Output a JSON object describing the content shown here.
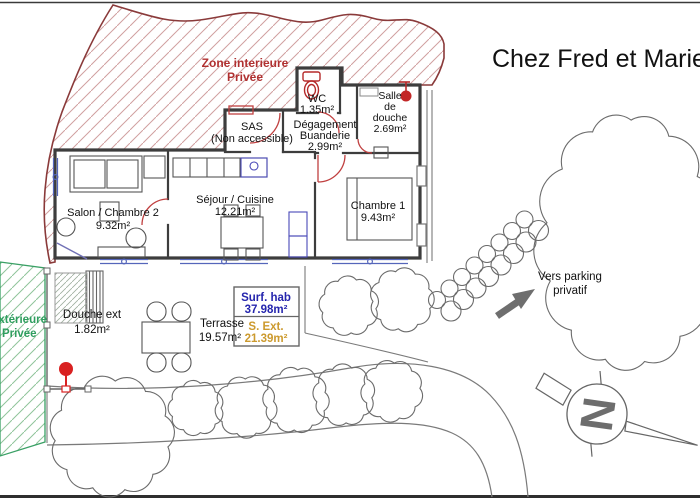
{
  "title": "Chez Fred et Marie",
  "zones": {
    "interior": {
      "line1": "Zone interieure",
      "line2": "Privée",
      "color": "#b03030"
    },
    "exterior": {
      "line1": "extérieure",
      "line2": "Privée",
      "color": "#2f9e5f"
    }
  },
  "rooms": {
    "wc": {
      "name": "WC",
      "area": "1.35m²"
    },
    "salle_douche": {
      "l1": "Salle",
      "l2": "de",
      "l3": "douche",
      "area": "2.69m²"
    },
    "sas": {
      "name": "SAS",
      "note": "(Non accessible)"
    },
    "degagement": {
      "l1": "Dégagement",
      "l2": "Buanderie",
      "area": "2.99m²"
    },
    "salon": {
      "name": "Salon / Chambre 2",
      "area": "9.32m²"
    },
    "sejour": {
      "name": "Séjour / Cuisine",
      "area": "12.21m²"
    },
    "chambre1": {
      "name": "Chambre 1",
      "area": "9.43m²"
    },
    "douche_ext": {
      "name": "Douche ext",
      "area": "1.82m²"
    },
    "terrasse": {
      "name": "Terrasse",
      "area": "19.57m²"
    }
  },
  "summary": {
    "hab_label": "Surf. hab",
    "hab_value": "37.98m²",
    "hab_color": "#2525ad",
    "ext_label": "S. Ext.",
    "ext_value": "21.39m²",
    "ext_color": "#cc9a2e"
  },
  "annotations": {
    "parking_line1": "Vers parking",
    "parking_line2": "privatif",
    "north_letter": "N"
  }
}
